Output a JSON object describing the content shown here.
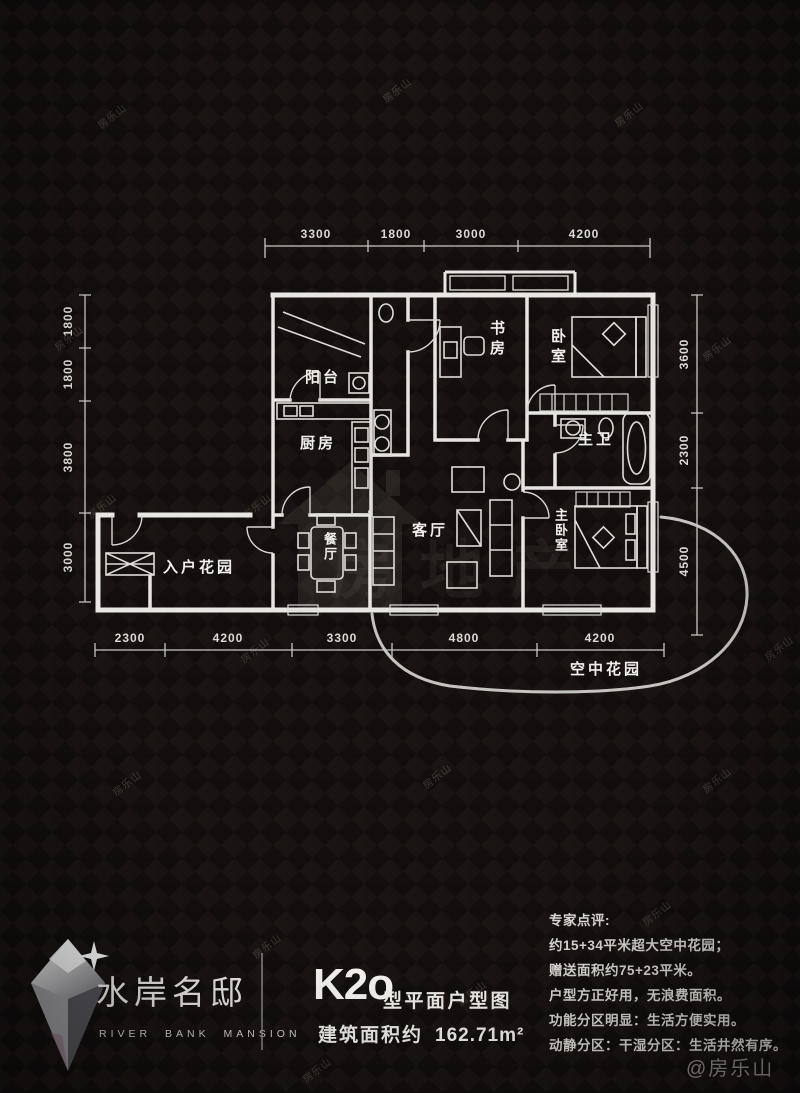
{
  "watermark": {
    "text": "房乐山",
    "handle": "@房乐山"
  },
  "center_watermark": {
    "brand": "房地产"
  },
  "plan": {
    "rooms": {
      "balcony": "阳台",
      "kitchen": "厨房",
      "study": "书房",
      "bedroom": "卧室",
      "master_bath": "主卫",
      "living": "客厅",
      "dining": "餐厅",
      "master_bedroom": "主卧室",
      "entry_garden": "入户花园",
      "sky_garden": "空中花园"
    },
    "dimensions": {
      "top": [
        "3300",
        "1800",
        "3000",
        "4200"
      ],
      "bottom": [
        "2300",
        "4200",
        "3300",
        "4800",
        "4200"
      ],
      "left": [
        "1800",
        "1800",
        "3800",
        "3000"
      ],
      "right": [
        "3600",
        "2300",
        "4500"
      ]
    }
  },
  "footer": {
    "brand_cn": "水岸名邸",
    "brand_en": "RIVER BANK MANSION",
    "unit_code": "K2o",
    "unit_suffix": "型平面户型图",
    "area_label": "建筑面积约",
    "area_value": "162.71m²",
    "review_title": "专家点评:",
    "review_lines": [
      "约15+34平米超大空中花园；",
      "赠送面积约75+23平米。",
      "户型方正好用，无浪费面积。",
      "功能分区明显：生活方便实用。",
      "动静分区：干湿分区：生活井然有序。"
    ]
  }
}
